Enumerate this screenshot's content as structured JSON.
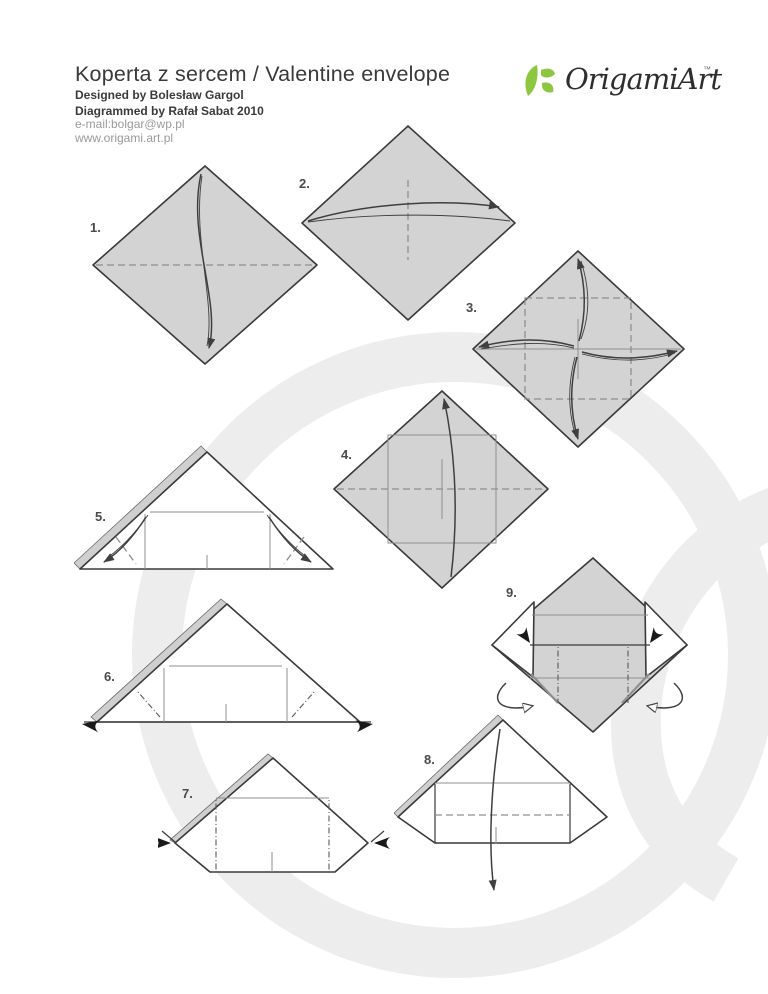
{
  "header": {
    "title": "Koperta z sercem / Valentine envelope",
    "designed_by": "Designed by Bolesław Gargol",
    "diagrammed_by": "Diagrammed by Rafał Sabat 2010",
    "email": "e-mail:bolgar@wp.pl",
    "website": "www.origami.art.pl"
  },
  "logo": {
    "brand": "OrigamiArt",
    "trademark": "™",
    "icon": "leaf-logo-icon"
  },
  "steps": [
    {
      "label": "1."
    },
    {
      "label": "2."
    },
    {
      "label": "3."
    },
    {
      "label": "4."
    },
    {
      "label": "5."
    },
    {
      "label": "6."
    },
    {
      "label": "7."
    },
    {
      "label": "8."
    },
    {
      "label": "9."
    }
  ],
  "colors": {
    "paper_fill": "#d3d3d3",
    "paper_white": "#ffffff",
    "outline": "#3a3a3a",
    "crease": "#8f8f8f",
    "arrow": "#3f3f3f",
    "watermark": "#ededed",
    "text_primary": "#3a3a3a",
    "text_muted": "#9a9a9a",
    "logo_green": "#8dc63f",
    "label": "#4a4a4a"
  }
}
